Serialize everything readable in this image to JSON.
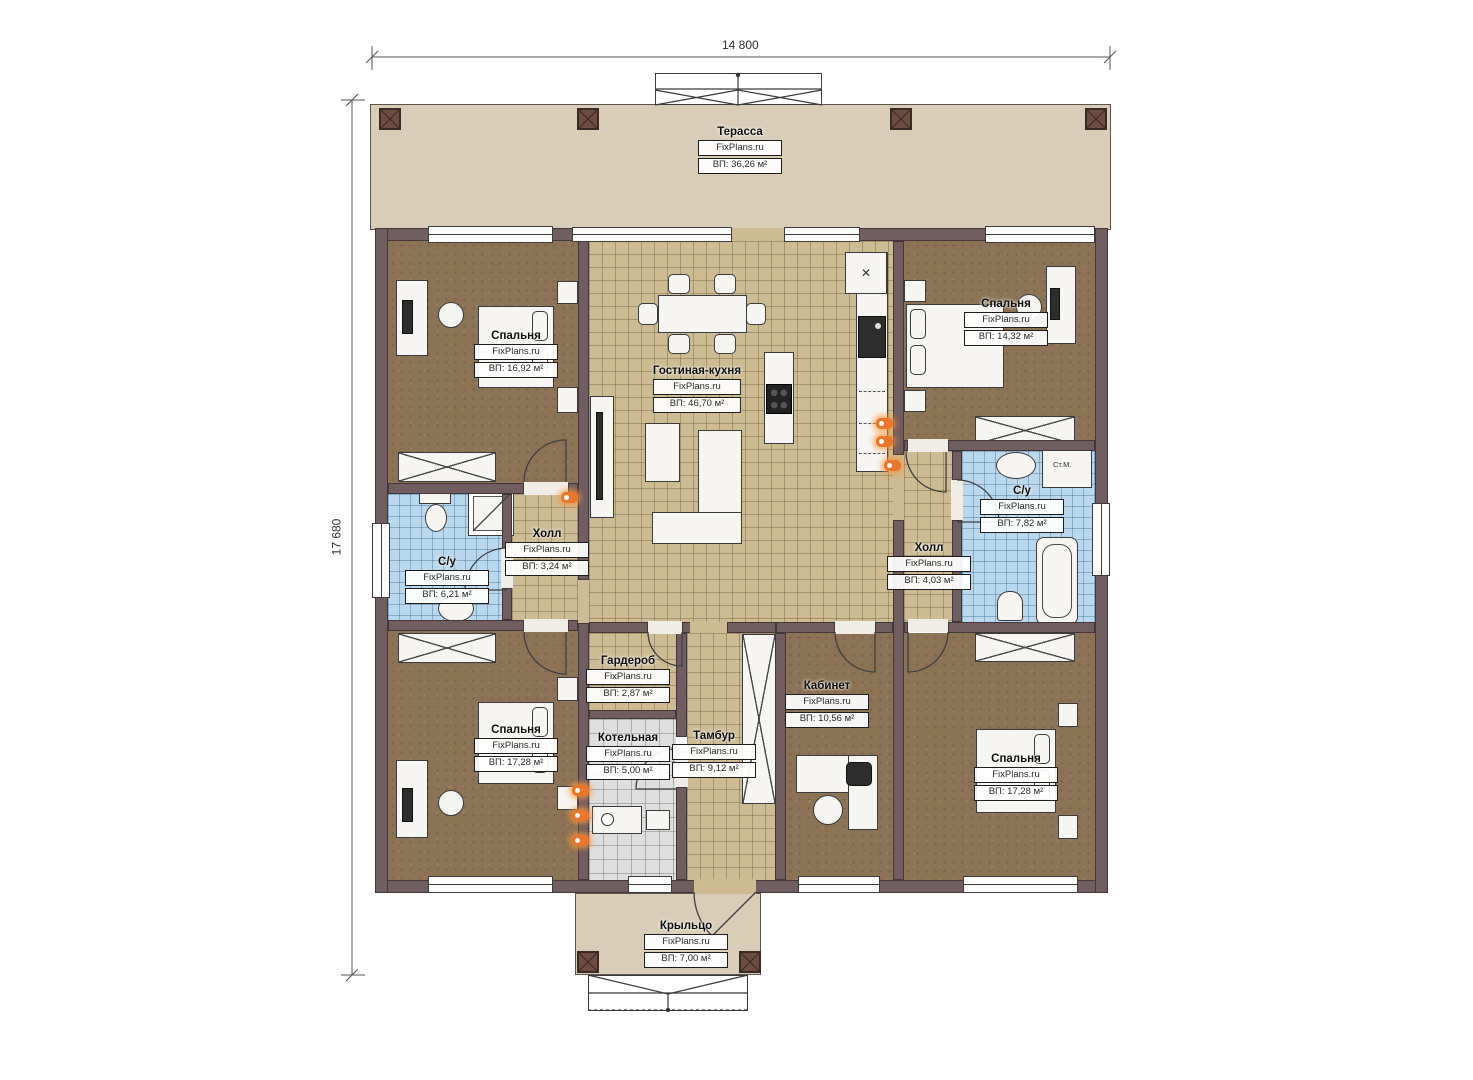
{
  "dimensions": {
    "width": "14 800",
    "height": "17 680"
  },
  "brand": "FixPlans.ru",
  "rooms": {
    "terrace": {
      "name": "Терасса",
      "area": "ВП: 36,26 м²"
    },
    "bedroom_tl": {
      "name": "Спальня",
      "area": "ВП: 16,92 м²"
    },
    "living_kitchen": {
      "name": "Гостиная-кухня",
      "area": "ВП: 46,70 м²"
    },
    "bedroom_tr": {
      "name": "Спальня",
      "area": "ВП: 14,32 м²"
    },
    "bathroom_left": {
      "name": "С/у",
      "area": "ВП: 6,21 м²"
    },
    "hall_left": {
      "name": "Холл",
      "area": "ВП: 3,24 м²"
    },
    "bathroom_right": {
      "name": "С/у",
      "area": "ВП: 7,82 м²"
    },
    "hall_right": {
      "name": "Холл",
      "area": "ВП: 4,03 м²"
    },
    "wardrobe_room": {
      "name": "Гардероб",
      "area": "ВП: 2,87 м²"
    },
    "boiler_room": {
      "name": "Котельная",
      "area": "ВП: 5,00 м²"
    },
    "vestibule": {
      "name": "Тамбур",
      "area": "ВП: 9,12 м²"
    },
    "office": {
      "name": "Кабинет",
      "area": "ВП: 10,56 м²"
    },
    "bedroom_bl": {
      "name": "Спальня",
      "area": "ВП: 17,28 м²"
    },
    "bedroom_br": {
      "name": "Спальня",
      "area": "ВП: 17,28 м²"
    },
    "porch": {
      "name": "Крыльцо",
      "area": "ВП: 7,00 м²"
    }
  },
  "annotations": {
    "washing_machine": "Ст.М.",
    "kitchen_vent": "✕"
  },
  "colors": {
    "wall": "#705d60",
    "terrace": "#d9cdb7",
    "bedroom_floor": "#8c7355",
    "tile_tan": "#cdbb94",
    "tile_blue": "#b9d8ee",
    "tile_gray": "#dedede",
    "heater_orange": "#e8772e"
  }
}
